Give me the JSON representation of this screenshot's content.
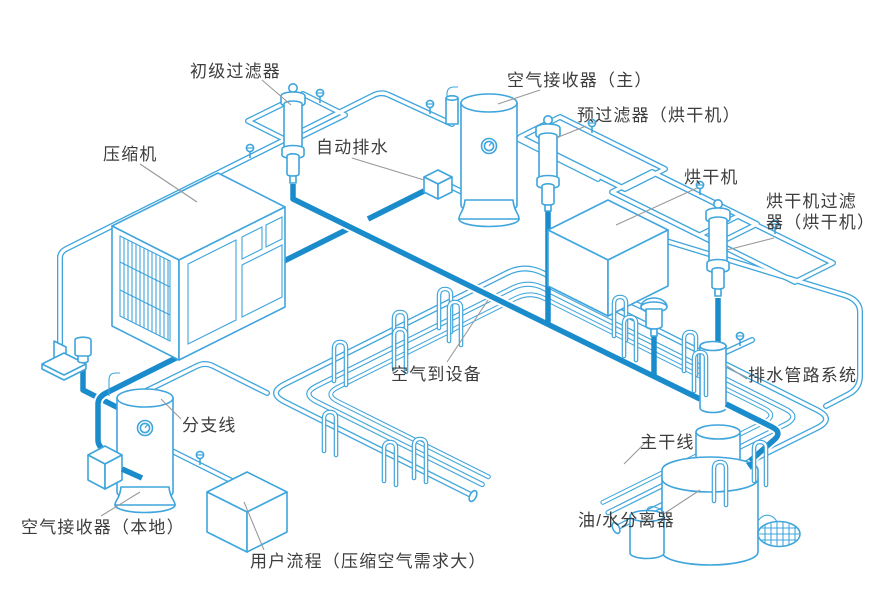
{
  "diagram": {
    "labels": {
      "primary_filter": "初级过滤器",
      "compressor": "压缩机",
      "auto_drain": "自动排水",
      "air_receiver_main": "空气接收器（主）",
      "pre_filter_dryer": "预过滤器（烘干机）",
      "dryer": "烘干机",
      "dryer_filter_line1": "烘干机过滤",
      "dryer_filter_line2": "器（烘干机）",
      "air_to_equipment": "空气到设备",
      "drain_piping_system": "排水管路系统",
      "branch_line": "分支线",
      "main_line": "主干线",
      "air_receiver_local": "空气接收器（本地）",
      "user_process": "用户流程（压缩空气需求大）",
      "oil_water_separator": "油/水分离器"
    },
    "colors": {
      "pipe_outline": "#3FA5DC",
      "drain_line": "#1B8CCB",
      "label_text": "#3D3D3D",
      "leader_line": "#999999",
      "background": "#FFFFFF"
    }
  }
}
